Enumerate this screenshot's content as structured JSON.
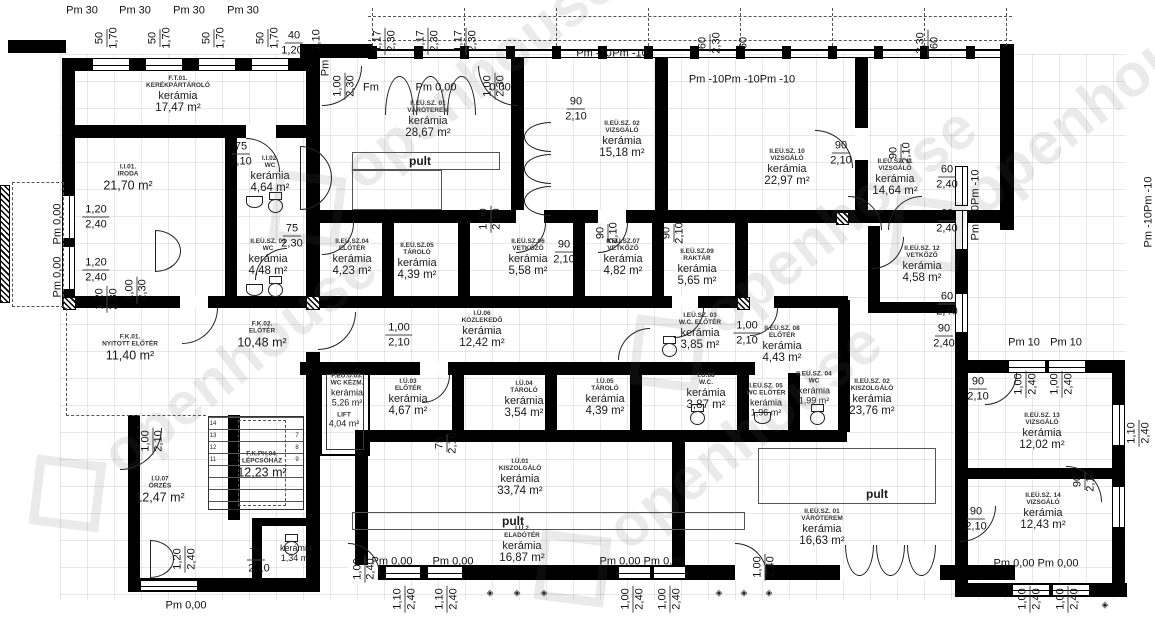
{
  "watermark": {
    "text": "openhouse"
  },
  "counters": {
    "label": "pult"
  },
  "stair_numbers": [
    "14",
    "13",
    "12",
    "11",
    "7",
    "8",
    "9"
  ],
  "rooms": [
    {
      "code": "F.T.01.",
      "name": "KERÉKPÁRTÁROLÓ",
      "material": "kerámia",
      "area": "17,47 m²"
    },
    {
      "code": "I.I.01.",
      "name": "IRODA",
      "area": "21,70 m²"
    },
    {
      "code": "I.I.02.",
      "name": "WC",
      "material": "kerámia",
      "area": "4,64 m²"
    },
    {
      "code": "II.EÜ.SZ. 01",
      "name": "VÁRÓTEREM",
      "material": "kerámia",
      "area": "28,67 m²"
    },
    {
      "code": "II.EÜ.SZ. 02",
      "name": "VIZSGÁLÓ",
      "material": "kerámia",
      "area": "15,18 m²"
    },
    {
      "code": "II.EÜ.SZ. 10",
      "name": "VIZSGÁLÓ",
      "material": "kerámia",
      "area": "22,97 m²"
    },
    {
      "code": "II.EÜ.SZ. 11",
      "name": "VIZSGÁLÓ",
      "material": "kerámia",
      "area": "14,64 m²"
    },
    {
      "code": "II.EÜ.SZ. 03",
      "name": "WC",
      "material": "kerámia",
      "area": "4,48 m²"
    },
    {
      "code": "II.EÜ.SZ.04",
      "name": "ELŐTÉR",
      "material": "kerámia",
      "area": "4,23 m²"
    },
    {
      "code": "II.EÜ.SZ.05",
      "name": "TÁROLÓ",
      "material": "kerámia",
      "area": "4,39 m²"
    },
    {
      "code": "II.EÜ.SZ.06",
      "name": "VETKŐZŐ",
      "material": "kerámia",
      "area": "5,58 m²"
    },
    {
      "code": "II.EÜ.SZ.07",
      "name": "VETKŐZŐ",
      "material": "kerámia",
      "area": "4,82 m²"
    },
    {
      "code": "II.EÜ.SZ.09",
      "name": "RAKTÁR",
      "material": "kerámia",
      "area": "5,65 m²"
    },
    {
      "code": "II.EÜ.SZ. 12",
      "name": "VETKŐZŐ",
      "material": "kerámia",
      "area": "4,58 m²"
    },
    {
      "code": "F.K.02.",
      "name": "ELŐTÉR",
      "area": "10,48 m²"
    },
    {
      "code": "F.K.01.",
      "name": "NYITOTT ELŐTÉR",
      "area": "11,40 m²"
    },
    {
      "code": "I.Ü.06",
      "name": "KÖZLEKEDŐ",
      "material": "kerámia",
      "area": "12,42 m²"
    },
    {
      "code": "I.EÜ.SZ. 03",
      "name": "W.C. ELŐTÉR",
      "material": "kerámia",
      "area": "3,85 m²"
    },
    {
      "code": "II.EÜ.SZ. 08",
      "name": "ELŐTÉR",
      "material": "kerámia",
      "area": "4,43 m²"
    },
    {
      "code": "II.EÜ.SZ. 02",
      "name": "KISZOLGÁLÓ",
      "material": "kerámia",
      "area": "23,76 m²"
    },
    {
      "code": "F.EÜ.U.03.",
      "name": "WC KÉZM.",
      "material": "kerámia",
      "area": "5,26 m²"
    },
    {
      "name": "LIFT",
      "area": "4,04 m²"
    },
    {
      "code": "I.Ü.03",
      "name": "ELŐTÉR",
      "material": "kerámia",
      "area": "4,67 m²"
    },
    {
      "code": "I.Ü.04",
      "name": "TÁROLÓ",
      "material": "kerámia",
      "area": "3,54 m²"
    },
    {
      "code": "I.Ü.05",
      "name": "TÁROLÓ",
      "material": "kerámia",
      "area": "4,39 m²"
    },
    {
      "code": "I.Ü.08",
      "name": "W.C.",
      "material": "kerámia",
      "area": "3,87 m²"
    },
    {
      "code": "I.EÜ.SZ. 05",
      "name": "WC ELŐTÉR",
      "material": "kerámia",
      "area": "1,96 m²"
    },
    {
      "code": "II.EÜ.SZ. 04",
      "name": "WC",
      "material": "kerámia",
      "area": "1,99 m²"
    },
    {
      "code": "I.Ü.01",
      "name": "KISZOLGÁLÓ",
      "material": "kerámia",
      "area": "33,74 m²"
    },
    {
      "code": "I.Ü.2",
      "name": "ELADÓTÉR",
      "material": "kerámia",
      "area": "16,87 m²"
    },
    {
      "code": "II.EÜ.SZ. 01",
      "name": "VÁRÓTEREM",
      "material": "kerámia",
      "area": "16,63 m²"
    },
    {
      "code": "II.EÜ.SZ. 13",
      "name": "VIZSGÁLÓ",
      "material": "kerámia",
      "area": "12,02 m²"
    },
    {
      "code": "II.EÜ.SZ. 14",
      "name": "VIZSGÁLÓ",
      "material": "kerámia",
      "area": "12,43 m²"
    },
    {
      "code": "I.Ü.07",
      "name": "ŐRZÉS",
      "area": "12,47 m²"
    },
    {
      "code": "F.K.PH.04.",
      "name": "LÉPCSŐHÁZ",
      "area": "12,23 m²"
    },
    {
      "material": "kerámia",
      "area": "1,34 m²"
    }
  ],
  "dims": [
    "Pm 30",
    "Pm 30",
    "Pm 30",
    "Pm 30",
    "50",
    "1,70",
    "50",
    "1,70",
    "50",
    "1,70",
    "50",
    "1,70",
    "40",
    "1,20",
    "1,10",
    "Pm",
    "1,00",
    "2,30",
    "Fm",
    "Pm 0,00",
    "0,00",
    "1,00",
    "2,30",
    "1,17",
    "2,30",
    "1,17",
    "2,30",
    "1,17",
    "2,30",
    "Pm -10",
    "Pm -10",
    "Pm -10Pm -10Pm -10",
    "60",
    "2,30",
    "60",
    "2,30",
    "60",
    "90",
    "2,10",
    "90",
    "2,10",
    "90",
    "2,10",
    "60",
    "2,40",
    "60",
    "2,40",
    "60",
    "2,40",
    "90",
    "2,40",
    "Pm -10Pm -10",
    "Pm -10Pm -10",
    "Pm 0,00",
    "Pm 0,00",
    "1,20",
    "2,40",
    "1,20",
    "2,40",
    "1,20",
    "2,30",
    "1,00",
    "2,30",
    "75",
    "2,10",
    "75",
    "2,30",
    "1,00",
    "2,10",
    "90",
    "2,10",
    "90",
    "2,10",
    "1,00",
    "2,10",
    "1,00",
    "2,10",
    "1,00",
    "2,10",
    "75",
    "2,10",
    "75",
    "2,10",
    "90",
    "2,10",
    "90",
    "2,10",
    "90",
    "2,10",
    "Pm 10",
    "Pm 10",
    "1,00",
    "2,40",
    "1,00",
    "2,40",
    "Pm 0,00",
    "Pm 0,00",
    "1,10",
    "2,40",
    "1,10",
    "2,40",
    "1,00",
    "2,40",
    "Pm 0,00",
    "Pm 0,00",
    "1,00",
    "2,40",
    "1,00",
    "2,40",
    "1,00",
    "2,40",
    "Pm 0,00",
    "Pm 0,00",
    "1,00",
    "2,40",
    "1,00",
    "2,40",
    "1,20",
    "2,40",
    "Pm 0,00",
    "1,10",
    "2,40",
    "90",
    "2,10"
  ]
}
